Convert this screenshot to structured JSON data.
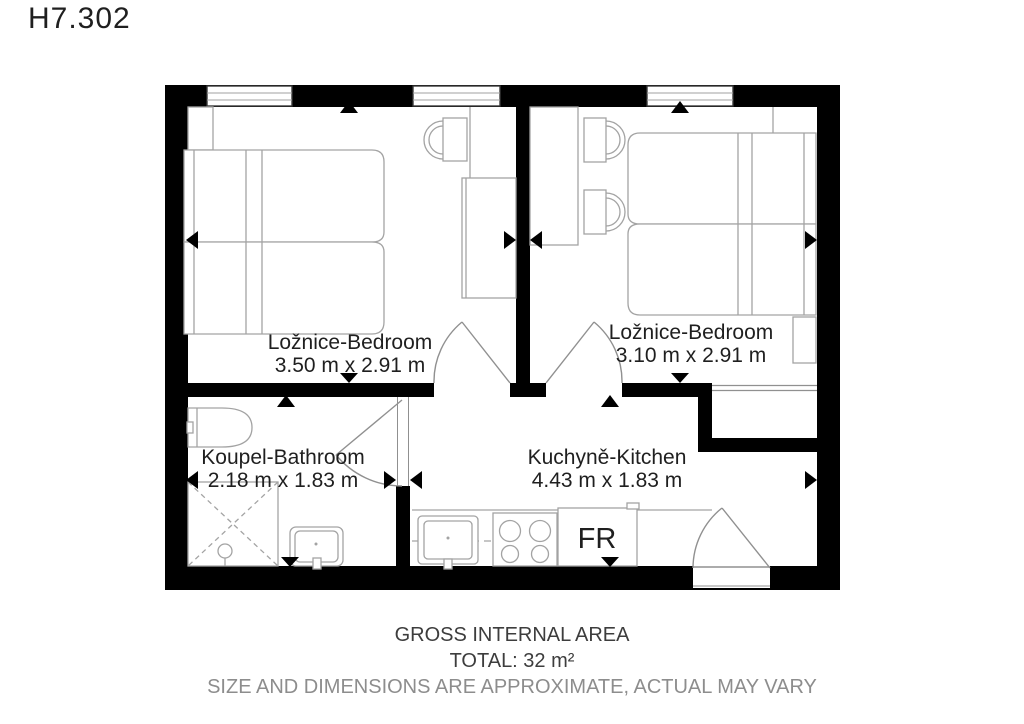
{
  "title": "H7.302",
  "rooms": [
    {
      "name": "Ložnice-Bedroom",
      "dimensions": "3.50 m x 2.91 m"
    },
    {
      "name": "Ložnice-Bedroom",
      "dimensions": "3.10 m x 2.91 m"
    },
    {
      "name": "Koupel-Bathroom",
      "dimensions": "2.18 m x 1.83 m"
    },
    {
      "name": "Kuchyně-Kitchen",
      "dimensions": "4.43 m x 1.83 m"
    }
  ],
  "labels": {
    "fridge": "FR"
  },
  "footer": {
    "line1": "GROSS INTERNAL AREA",
    "line2": "TOTAL: 32 m²",
    "line3": "SIZE AND DIMENSIONS ARE APPROXIMATE, ACTUAL MAY VARY"
  },
  "colors": {
    "wall": "#000000",
    "furniture_line": "#a3a3a3",
    "door_line": "#909090",
    "label_text": "#1f1f1f",
    "footer_text": "#3d3d3d",
    "footer_muted": "#8d8d8d"
  }
}
